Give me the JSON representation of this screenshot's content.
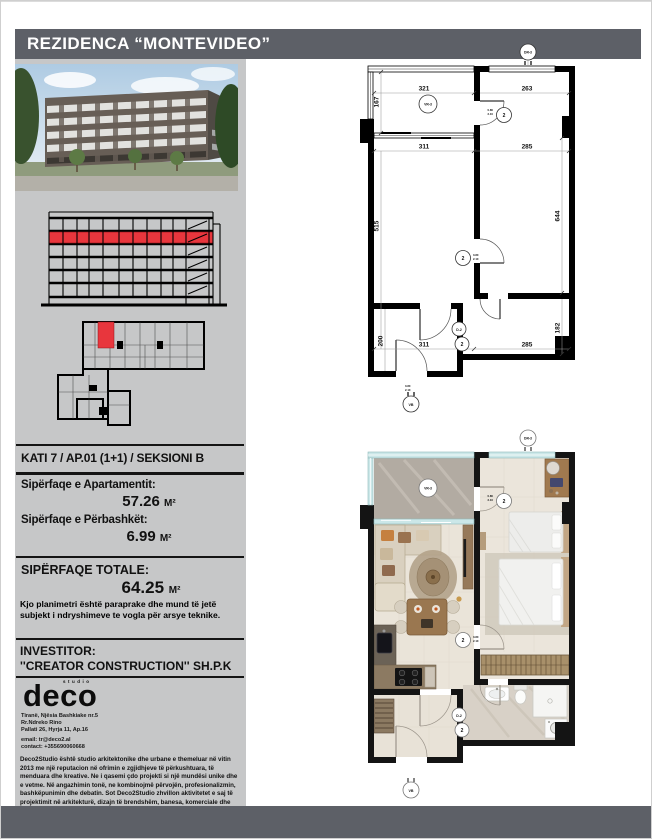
{
  "header": {
    "title": "REZIDENCA “MONTEVIDEO”"
  },
  "colors": {
    "accent_red": "#e8363d",
    "bar_gray": "#5d6067",
    "panel_gray": "#c6c7c8"
  },
  "left_panel": {
    "unit_heading": "KATI 7 / AP.01 (1+1) / SEKSIONI B",
    "areas": [
      {
        "label": "Sipërfaqe e Apartamentit:",
        "value": "57.26",
        "unit": "M²"
      },
      {
        "label": "Sipërfaqe e Përbashkët:",
        "value": "6.99",
        "unit": "M²"
      }
    ],
    "total": {
      "label": "SIPËRFAQE TOTALE:",
      "value": "64.25",
      "unit": "M²"
    },
    "note": "Kjo planimetri është paraprake dhe mund të jetë subjekt i ndryshimeve te vogla për arsye teknike.",
    "investor_label": "INVESTITOR:",
    "investor_name": "''CREATOR CONSTRUCTION'' SH.P.K",
    "studio": {
      "logo": "deco",
      "logo_sub": "studio",
      "address_lines": [
        "Tiranë, Njësia Bashkiake nr.5",
        "Rr.Ndreko Rino",
        "Pallati 26, Hyrja 11, Ap.16"
      ],
      "email": "email: tr@deco2.al",
      "contact": "contact: +355690060668",
      "about": "Deco2Studio është studio arkitektonike dhe urbane e themeluar në vitin 2013 me një reputacion në ofrimin e zgjidhjeve të përkushtuara, të menduara dhe kreative. Ne i qasemi çdo projekti si një mundësi unike dhe e vetme. Në angazhimin tonë, ne kombinojmë përvojën, profesionalizmin, bashkëpunimin dhe debatin. Sot Deco2Studio zhvillon aktivitetet e saj të projektimit në arkitekturë, dizajn të brendshëm, banesa, komerciale dhe planifikim urban."
    }
  },
  "plans": {
    "dims": {
      "top": [
        "321",
        "263"
      ],
      "mid": [
        "311",
        "285"
      ],
      "bottom": [
        "311",
        "285"
      ],
      "left": [
        "167",
        "515",
        "200"
      ],
      "right": [
        "644",
        "182"
      ]
    },
    "markers": {
      "window_top": "DR-3",
      "window_balcony": "VR-3",
      "door": "2",
      "door_hall": "D-2",
      "entry": "VB"
    },
    "door_size": {
      "w": "0.80",
      "h": "2.10"
    }
  }
}
